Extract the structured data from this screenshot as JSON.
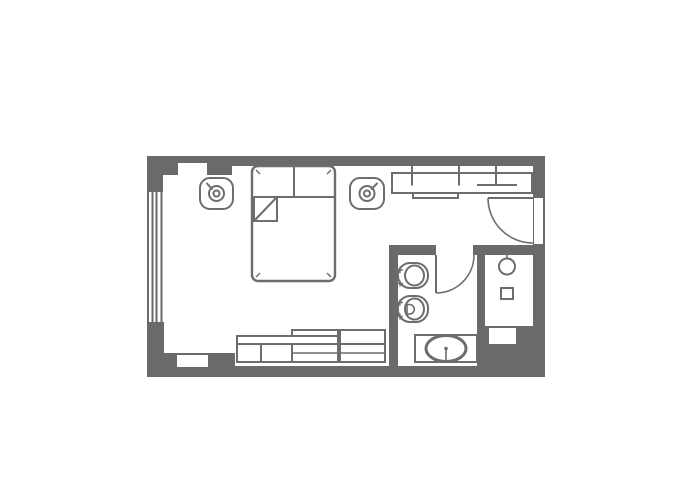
{
  "canvas": {
    "width": 700,
    "height": 500
  },
  "colors": {
    "background": "#ffffff",
    "wall": "#6a6a6a",
    "outline": "#6d6d6d"
  },
  "plan": {
    "walls": [
      {
        "name": "wall-top",
        "x": 147,
        "y": 156,
        "w": 398,
        "h": 10
      },
      {
        "name": "wall-top-left-thick",
        "x": 163,
        "y": 156,
        "w": 69,
        "h": 19
      },
      {
        "name": "wall-left-upper",
        "x": 147,
        "y": 156,
        "w": 16,
        "h": 37
      },
      {
        "name": "wall-left-lower",
        "x": 147,
        "y": 322,
        "w": 17,
        "h": 55
      },
      {
        "name": "wall-bottom",
        "x": 147,
        "y": 366,
        "w": 398,
        "h": 11
      },
      {
        "name": "wall-bottom-left-thick",
        "x": 147,
        "y": 353,
        "w": 88,
        "h": 24
      },
      {
        "name": "wall-right",
        "x": 533,
        "y": 156,
        "w": 12,
        "h": 221
      },
      {
        "name": "wall-bathroom-north",
        "x": 389,
        "y": 245,
        "w": 144,
        "h": 10
      },
      {
        "name": "wall-bathroom-west",
        "x": 389,
        "y": 245,
        "w": 9,
        "h": 132
      },
      {
        "name": "wall-shower-divider",
        "x": 477,
        "y": 255,
        "w": 8,
        "h": 71
      },
      {
        "name": "wall-bottom-right-block",
        "x": 477,
        "y": 326,
        "w": 56,
        "h": 51
      }
    ],
    "window": {
      "name": "window-left",
      "frame": {
        "x": 147,
        "y": 192,
        "w": 16,
        "h": 130
      },
      "bars": [
        {
          "x": 147,
          "y": 192,
          "w": 2,
          "h": 130
        },
        {
          "x": 151.5,
          "y": 192,
          "w": 2,
          "h": 130
        },
        {
          "x": 155.5,
          "y": 192,
          "w": 2,
          "h": 130
        },
        {
          "x": 160.5,
          "y": 192,
          "w": 2,
          "h": 130
        }
      ]
    },
    "openings": [
      {
        "name": "niche-top-left",
        "x": 178,
        "y": 163,
        "w": 29,
        "h": 14
      },
      {
        "name": "niche-bottom-left",
        "x": 177,
        "y": 355,
        "w": 31,
        "h": 12
      },
      {
        "name": "entry-door-opening",
        "x": 534,
        "y": 198,
        "w": 9,
        "h": 46
      },
      {
        "name": "bathroom-door-opening",
        "x": 436,
        "y": 245,
        "w": 37,
        "h": 10
      },
      {
        "name": "niche-shower-south",
        "x": 489,
        "y": 328,
        "w": 27,
        "h": 16
      }
    ],
    "furniture": [
      {
        "name": "double-bed",
        "shapes": [
          {
            "t": "rect",
            "x": 252,
            "y": 166,
            "w": 83,
            "h": 115,
            "rx": 6,
            "sw": 2.4,
            "fill": "#ffffff"
          },
          {
            "t": "line",
            "x1": 252,
            "y1": 197,
            "x2": 335,
            "y2": 197,
            "sw": 2
          },
          {
            "t": "line",
            "x1": 294,
            "y1": 166,
            "x2": 294,
            "y2": 197,
            "sw": 2
          },
          {
            "t": "rect",
            "x": 254,
            "y": 197,
            "w": 23,
            "h": 24,
            "sw": 2,
            "fill": "#ffffff"
          },
          {
            "t": "line",
            "x1": 254,
            "y1": 221,
            "x2": 277,
            "y2": 197,
            "sw": 2
          },
          {
            "t": "line",
            "x1": 256,
            "y1": 170,
            "x2": 260,
            "y2": 174,
            "sw": 1.5
          },
          {
            "t": "line",
            "x1": 331,
            "y1": 170,
            "x2": 327,
            "y2": 174,
            "sw": 1.5
          },
          {
            "t": "line",
            "x1": 256,
            "y1": 277,
            "x2": 260,
            "y2": 273,
            "sw": 1.5
          },
          {
            "t": "line",
            "x1": 331,
            "y1": 277,
            "x2": 327,
            "y2": 273,
            "sw": 1.5
          }
        ]
      },
      {
        "name": "ceiling-lamp-left",
        "shapes": [
          {
            "t": "rect",
            "x": 200,
            "y": 178,
            "w": 33,
            "h": 31,
            "rx": 10,
            "sw": 2,
            "fill": "#ffffff"
          },
          {
            "t": "circle",
            "cx": 216.5,
            "cy": 193.5,
            "r": 7.5,
            "sw": 2
          },
          {
            "t": "circle",
            "cx": 216.5,
            "cy": 193.5,
            "r": 3,
            "sw": 2
          },
          {
            "t": "line",
            "x1": 212.5,
            "y1": 189.5,
            "x2": 206.5,
            "y2": 183,
            "sw": 2
          }
        ]
      },
      {
        "name": "ceiling-lamp-right",
        "shapes": [
          {
            "t": "rect",
            "x": 350,
            "y": 178,
            "w": 34,
            "h": 31,
            "rx": 10,
            "sw": 2,
            "fill": "#ffffff"
          },
          {
            "t": "circle",
            "cx": 367,
            "cy": 193.5,
            "r": 7.5,
            "sw": 2
          },
          {
            "t": "circle",
            "cx": 367,
            "cy": 193.5,
            "r": 3,
            "sw": 2
          },
          {
            "t": "line",
            "x1": 371,
            "y1": 189.5,
            "x2": 377.5,
            "y2": 183,
            "sw": 2
          }
        ]
      },
      {
        "name": "wardrobe",
        "shapes": [
          {
            "t": "rect",
            "x": 392,
            "y": 173,
            "w": 140,
            "h": 20,
            "sw": 2,
            "fill": "#ffffff"
          },
          {
            "t": "line",
            "x1": 412,
            "y1": 166,
            "x2": 412,
            "y2": 185.5,
            "sw": 2
          },
          {
            "t": "line",
            "x1": 459,
            "y1": 166,
            "x2": 459,
            "y2": 185.5,
            "sw": 2
          },
          {
            "t": "line",
            "x1": 496,
            "y1": 166,
            "x2": 496,
            "y2": 185.5,
            "sw": 2
          },
          {
            "t": "line",
            "x1": 477,
            "y1": 185,
            "x2": 517,
            "y2": 185,
            "sw": 2
          },
          {
            "t": "rect",
            "x": 413,
            "y": 193,
            "w": 45,
            "h": 5,
            "sw": 2,
            "fill": "#ffffff"
          }
        ]
      },
      {
        "name": "entry-door",
        "shapes": [
          {
            "t": "line",
            "x1": 488,
            "y1": 198,
            "x2": 533,
            "y2": 198,
            "sw": 2
          },
          {
            "t": "path",
            "d": "M488,198 A45,45 0 0 0 533,243",
            "sw": 1.6
          }
        ]
      },
      {
        "name": "bathroom-door",
        "shapes": [
          {
            "t": "line",
            "x1": 436,
            "y1": 255,
            "x2": 436,
            "y2": 293,
            "sw": 2
          },
          {
            "t": "path",
            "d": "M436,293 A38,38 0 0 0 474,255",
            "sw": 1.6
          }
        ]
      },
      {
        "name": "toilet",
        "shapes": [
          {
            "t": "rect",
            "x": 398,
            "y": 263,
            "w": 30,
            "h": 25,
            "rx": 12,
            "sw": 2,
            "fill": "#ffffff"
          },
          {
            "t": "ellipse",
            "cx": 414.5,
            "cy": 275.5,
            "rx": 9.5,
            "ry": 10,
            "sw": 2
          },
          {
            "t": "line",
            "x1": 397,
            "y1": 270,
            "x2": 403,
            "y2": 270,
            "sw": 1.4
          },
          {
            "t": "line",
            "x1": 400,
            "y1": 267,
            "x2": 400,
            "y2": 273,
            "sw": 1.4
          },
          {
            "t": "line",
            "x1": 397,
            "y1": 283.5,
            "x2": 403,
            "y2": 283.5,
            "sw": 1.4
          },
          {
            "t": "line",
            "x1": 400,
            "y1": 280.5,
            "x2": 400,
            "y2": 286.5,
            "sw": 1.4
          }
        ]
      },
      {
        "name": "bidet",
        "shapes": [
          {
            "t": "rect",
            "x": 398,
            "y": 296,
            "w": 30,
            "h": 26,
            "rx": 12,
            "sw": 2,
            "fill": "#ffffff"
          },
          {
            "t": "ellipse",
            "cx": 414.5,
            "cy": 309,
            "rx": 9.5,
            "ry": 10.5,
            "sw": 2
          },
          {
            "t": "path",
            "d": "M407,304.5 h2.5 a4.8,4.8 0 0 1 0,9.6 h-2.5 z",
            "sw": 1.6
          },
          {
            "t": "line",
            "x1": 397,
            "y1": 302.5,
            "x2": 403,
            "y2": 302.5,
            "sw": 1.4
          },
          {
            "t": "line",
            "x1": 400,
            "y1": 299.5,
            "x2": 400,
            "y2": 305.5,
            "sw": 1.4
          },
          {
            "t": "line",
            "x1": 397,
            "y1": 316.5,
            "x2": 403,
            "y2": 316.5,
            "sw": 1.4
          },
          {
            "t": "line",
            "x1": 400,
            "y1": 313.5,
            "x2": 400,
            "y2": 319.5,
            "sw": 1.4
          }
        ]
      },
      {
        "name": "sink-vanity",
        "shapes": [
          {
            "t": "rect",
            "x": 415,
            "y": 335,
            "w": 62,
            "h": 27,
            "sw": 2,
            "fill": "#ffffff"
          },
          {
            "t": "ellipse",
            "cx": 446,
            "cy": 348.5,
            "rx": 20,
            "ry": 13,
            "sw": 3
          },
          {
            "t": "line",
            "x1": 446,
            "y1": 348.5,
            "x2": 446,
            "y2": 363,
            "sw": 1.6
          },
          {
            "t": "circle",
            "cx": 446,
            "cy": 348.5,
            "r": 1.8,
            "sw": 0,
            "fill": "#6d6d6d"
          }
        ]
      },
      {
        "name": "shower",
        "shapes": [
          {
            "t": "line",
            "x1": 507,
            "y1": 248,
            "x2": 507,
            "y2": 259,
            "sw": 1.6
          },
          {
            "t": "circle",
            "cx": 507,
            "cy": 266.5,
            "r": 8,
            "sw": 2
          },
          {
            "t": "rect",
            "x": 501,
            "y": 288,
            "w": 12,
            "h": 11,
            "sw": 2,
            "fill": "#ffffff"
          }
        ]
      },
      {
        "name": "sideboard",
        "shapes": [
          {
            "t": "rect",
            "x": 292,
            "y": 330,
            "w": 46,
            "h": 14,
            "sw": 2,
            "fill": "#ffffff"
          },
          {
            "t": "rect",
            "x": 340,
            "y": 330,
            "w": 45,
            "h": 14,
            "sw": 2,
            "fill": "#ffffff"
          },
          {
            "t": "rect",
            "x": 237,
            "y": 336,
            "w": 101,
            "h": 8,
            "sw": 2,
            "fill": "#ffffff"
          },
          {
            "t": "rect",
            "x": 237,
            "y": 344,
            "w": 55,
            "h": 18,
            "sw": 2,
            "fill": "#ffffff"
          },
          {
            "t": "rect",
            "x": 292,
            "y": 344,
            "w": 46,
            "h": 18,
            "sw": 2,
            "fill": "#ffffff"
          },
          {
            "t": "rect",
            "x": 340,
            "y": 344,
            "w": 45,
            "h": 18,
            "sw": 2,
            "fill": "#ffffff"
          },
          {
            "t": "line",
            "x1": 261,
            "y1": 344,
            "x2": 261,
            "y2": 362,
            "sw": 2
          },
          {
            "t": "line",
            "x1": 292,
            "y1": 353,
            "x2": 385,
            "y2": 353,
            "sw": 1.6
          }
        ]
      }
    ]
  }
}
